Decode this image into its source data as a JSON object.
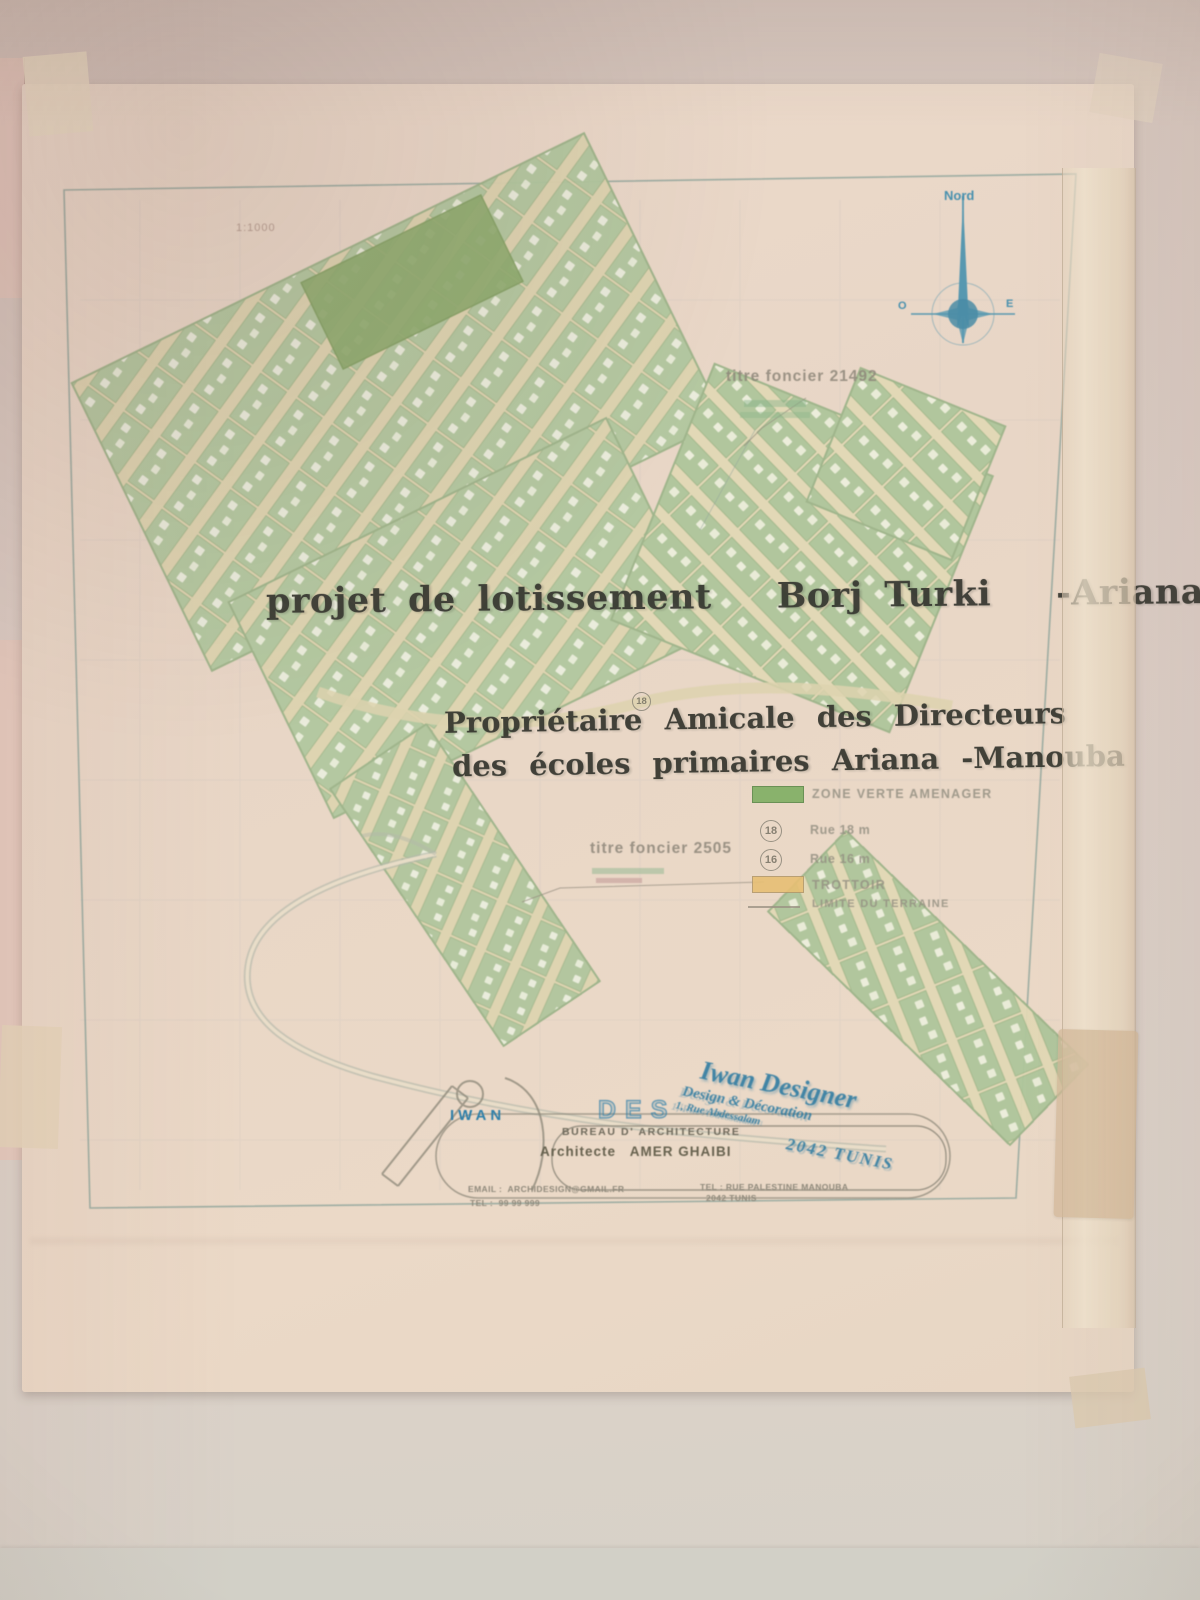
{
  "colors": {
    "wall": "#d9ccc4",
    "paper": "#e9d7c8",
    "parcel_green": "#b2c8a0",
    "zone_verte_green": "#8cab6d",
    "street_cream": "#ded4b0",
    "trottoir_tan": "#e7bf74",
    "stamp_blue": "#2b7ca8",
    "ink_dark": "#34352e",
    "map_gray": "#8d8679"
  },
  "plan": {
    "scale_note": "1:1000",
    "compass": {
      "north": "Nord",
      "west": "O",
      "east": "E"
    },
    "titre_foncier_right": "titre foncier 21492",
    "titre_foncier_left": "titre foncier 2505",
    "title_stamp": "projet de lotissement   Borj Turki   -Ariana",
    "owner_stamp_line1": "Propriétaire Amicale des Directeurs",
    "owner_stamp_line2": "des écoles primaires Ariana -Manouba",
    "lot_badge": "18",
    "legend": {
      "zone_verte": "ZONE VERTE AMENAGER",
      "rue18_badge": "18",
      "rue18": "Rue 18 m",
      "rue16_badge": "16",
      "rue16": "Rue 16 m",
      "trottoir": "TROTTOIR",
      "limite": "LIMITE DU TERRAINE"
    },
    "cartouche": {
      "logo": "IWAN",
      "logo_outline": "DES",
      "bureau": "BUREAU D' ARCHITECTURE",
      "architect": "Architecte   AMER GHAIBI",
      "email": "EMAIL :  ARCHIDESIGN@GMAIL.FR",
      "tel": "TEL :  99 99 999",
      "addr1": "TEL : RUE PALESTINE MANOUBA",
      "addr2": "2042 TUNIS"
    },
    "stamp": {
      "line1": "Iwan Designer",
      "line2": "Design & Décoration",
      "line3": "1, Rue Abdessalam",
      "line4": "2042 TUNIS"
    }
  }
}
